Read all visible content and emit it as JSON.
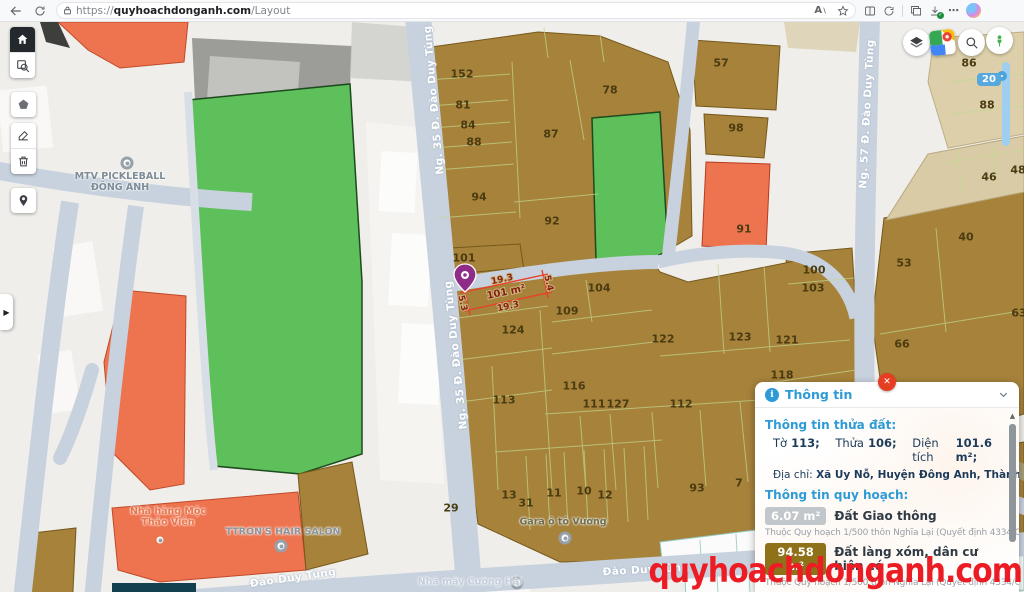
{
  "browser": {
    "url_scheme": "https://",
    "url_domain": "quyhoachdonganh.com",
    "url_path": "/Layout",
    "icons_left": [
      "back-icon",
      "refresh-icon",
      "lock-icon"
    ],
    "icons_right": [
      "read-aloud-icon",
      "favorite-star-icon",
      "split-screen-icon",
      "refresh-circle-icon",
      "collections-icon",
      "downloads-icon",
      "more-dots-icon",
      "copilot-icon"
    ],
    "more_dots": "⋯"
  },
  "map_toolbar": {
    "items": [
      "home",
      "area-zoom",
      "polygon-draw",
      "edit",
      "delete",
      "marker"
    ]
  },
  "map_controls": {
    "items": [
      "layers",
      "google-maps",
      "search",
      "street-view"
    ],
    "zoom_value": "20"
  },
  "map": {
    "selection": {
      "top": "19.3",
      "bottom": "19.3",
      "left": "5.3",
      "right": "5.4",
      "area": "101 m²"
    },
    "parcel_labels": [
      {
        "t": "152",
        "x": 462,
        "y": 52
      },
      {
        "t": "81",
        "x": 463,
        "y": 83
      },
      {
        "t": "84",
        "x": 468,
        "y": 103
      },
      {
        "t": "88",
        "x": 474,
        "y": 120
      },
      {
        "t": "94",
        "x": 479,
        "y": 175
      },
      {
        "t": "87",
        "x": 551,
        "y": 112
      },
      {
        "t": "92",
        "x": 552,
        "y": 199
      },
      {
        "t": "78",
        "x": 610,
        "y": 68
      },
      {
        "t": "57",
        "x": 721,
        "y": 41
      },
      {
        "t": "98",
        "x": 736,
        "y": 106
      },
      {
        "t": "86",
        "x": 969,
        "y": 41
      },
      {
        "t": "88",
        "x": 987,
        "y": 83
      },
      {
        "t": "91",
        "x": 744,
        "y": 207
      },
      {
        "t": "46",
        "x": 989,
        "y": 155
      },
      {
        "t": "48",
        "x": 1018,
        "y": 148
      },
      {
        "t": "101",
        "x": 464,
        "y": 236
      },
      {
        "t": "104",
        "x": 599,
        "y": 266
      },
      {
        "t": "109",
        "x": 567,
        "y": 289
      },
      {
        "t": "100",
        "x": 814,
        "y": 248
      },
      {
        "t": "103",
        "x": 813,
        "y": 266
      },
      {
        "t": "124",
        "x": 513,
        "y": 308
      },
      {
        "t": "122",
        "x": 663,
        "y": 317
      },
      {
        "t": "123",
        "x": 740,
        "y": 315
      },
      {
        "t": "121",
        "x": 787,
        "y": 318
      },
      {
        "t": "118",
        "x": 782,
        "y": 353
      },
      {
        "t": "116",
        "x": 574,
        "y": 364
      },
      {
        "t": "113",
        "x": 504,
        "y": 378
      },
      {
        "t": "111",
        "x": 594,
        "y": 382
      },
      {
        "t": "127",
        "x": 618,
        "y": 382
      },
      {
        "t": "112",
        "x": 681,
        "y": 382
      },
      {
        "t": "40",
        "x": 966,
        "y": 215
      },
      {
        "t": "53",
        "x": 904,
        "y": 241
      },
      {
        "t": "66",
        "x": 902,
        "y": 322
      },
      {
        "t": "63",
        "x": 1019,
        "y": 291
      },
      {
        "t": "29",
        "x": 451,
        "y": 486
      },
      {
        "t": "13",
        "x": 509,
        "y": 473
      },
      {
        "t": "31",
        "x": 526,
        "y": 481
      },
      {
        "t": "11",
        "x": 554,
        "y": 471
      },
      {
        "t": "10",
        "x": 584,
        "y": 469
      },
      {
        "t": "12",
        "x": 605,
        "y": 473
      },
      {
        "t": "93",
        "x": 697,
        "y": 466
      },
      {
        "t": "7",
        "x": 739,
        "y": 461
      }
    ],
    "street_labels": [
      {
        "t": "Ng. 35 Đ. Đào Duy Tùng",
        "x": 434,
        "y": 78,
        "r": -95
      },
      {
        "t": "Ng. 35 Đ. Đào Duy Tùng",
        "x": 456,
        "y": 333,
        "r": -96
      },
      {
        "t": "Ng. 57 Đ. Đào Duy Tùng",
        "x": 867,
        "y": 92,
        "r": -87
      },
      {
        "t": "Đào Duy Tùng",
        "x": 293,
        "y": 556,
        "r": -8
      },
      {
        "t": "Đào Duy Tùng",
        "x": 646,
        "y": 548,
        "r": -3
      }
    ],
    "poi_labels": [
      {
        "t": "MTV PICKLEBALL\nĐÔNG ANH",
        "x": 120,
        "y": 160,
        "c": "#7E8C96",
        "mx": 127,
        "my": 141,
        "mc": "#97A1A9"
      },
      {
        "t": "TTRON'S HAIR SALON",
        "x": 283,
        "y": 510,
        "c": "#8A949C",
        "mx": 281,
        "my": 524,
        "mc": "#97A1A9"
      },
      {
        "t": "Nhà hàng Mộc\nThảo Viên",
        "x": 168,
        "y": 495,
        "c": "#E8764C",
        "mx": 160,
        "my": 518,
        "mc": "#E8764C"
      },
      {
        "t": "Nhà máy Cường Hải",
        "x": 470,
        "y": 560,
        "c": "#C2CEDA",
        "mx": 517,
        "my": 561,
        "mc": "#97A1A9"
      },
      {
        "t": "Gara ô tô Vương",
        "x": 563,
        "y": 500,
        "c": "#6E6F50",
        "mx": 565,
        "my": 516,
        "mc": "#97A1A9"
      }
    ]
  },
  "panel": {
    "title": "Thông tin",
    "section1_title": "Thông tin thửa đất:",
    "to_label": "Tờ",
    "to_value": "113;",
    "thua_label": "Thửa",
    "thua_value": "106;",
    "dientich_label": "Diện tích",
    "dientich_value": "101.6 m²;",
    "address_label": "Địa chỉ:",
    "address_value": "Xã Uy Nỗ, Huyện Đông Anh, Thành phố Hà Nội",
    "section2_title": "Thông tin quy hoạch:",
    "zones": [
      {
        "area": "6.07 m²",
        "name": "Đất Giao thông",
        "badge_bg": "#C2C7CB",
        "note": "Thuộc Quy hoạch 1/500 thôn Nghĩa Lại (Quyết định 4334/QĐ-UBND)"
      },
      {
        "area": "94.58 m²",
        "name": "Đất làng xóm, dân cư hiện có",
        "badge_bg": "#8E7119",
        "note": "Thuộc Quy hoạch 1/500 thôn Nghĩa Lại (Quyết định 4334/QĐ-UBND)"
      }
    ]
  },
  "watermark": "quyhoachdonganh.com",
  "colors": {
    "accent_blue": "#2E9BD6",
    "close_red": "#E63E22",
    "watermark_red": "#EC1C24",
    "selection_red": "#E8402A",
    "parcel_brown": "#A6823B",
    "parcel_green": "#5EC05A",
    "parcel_orange": "#EE7450",
    "road": "#C8D2DE"
  }
}
